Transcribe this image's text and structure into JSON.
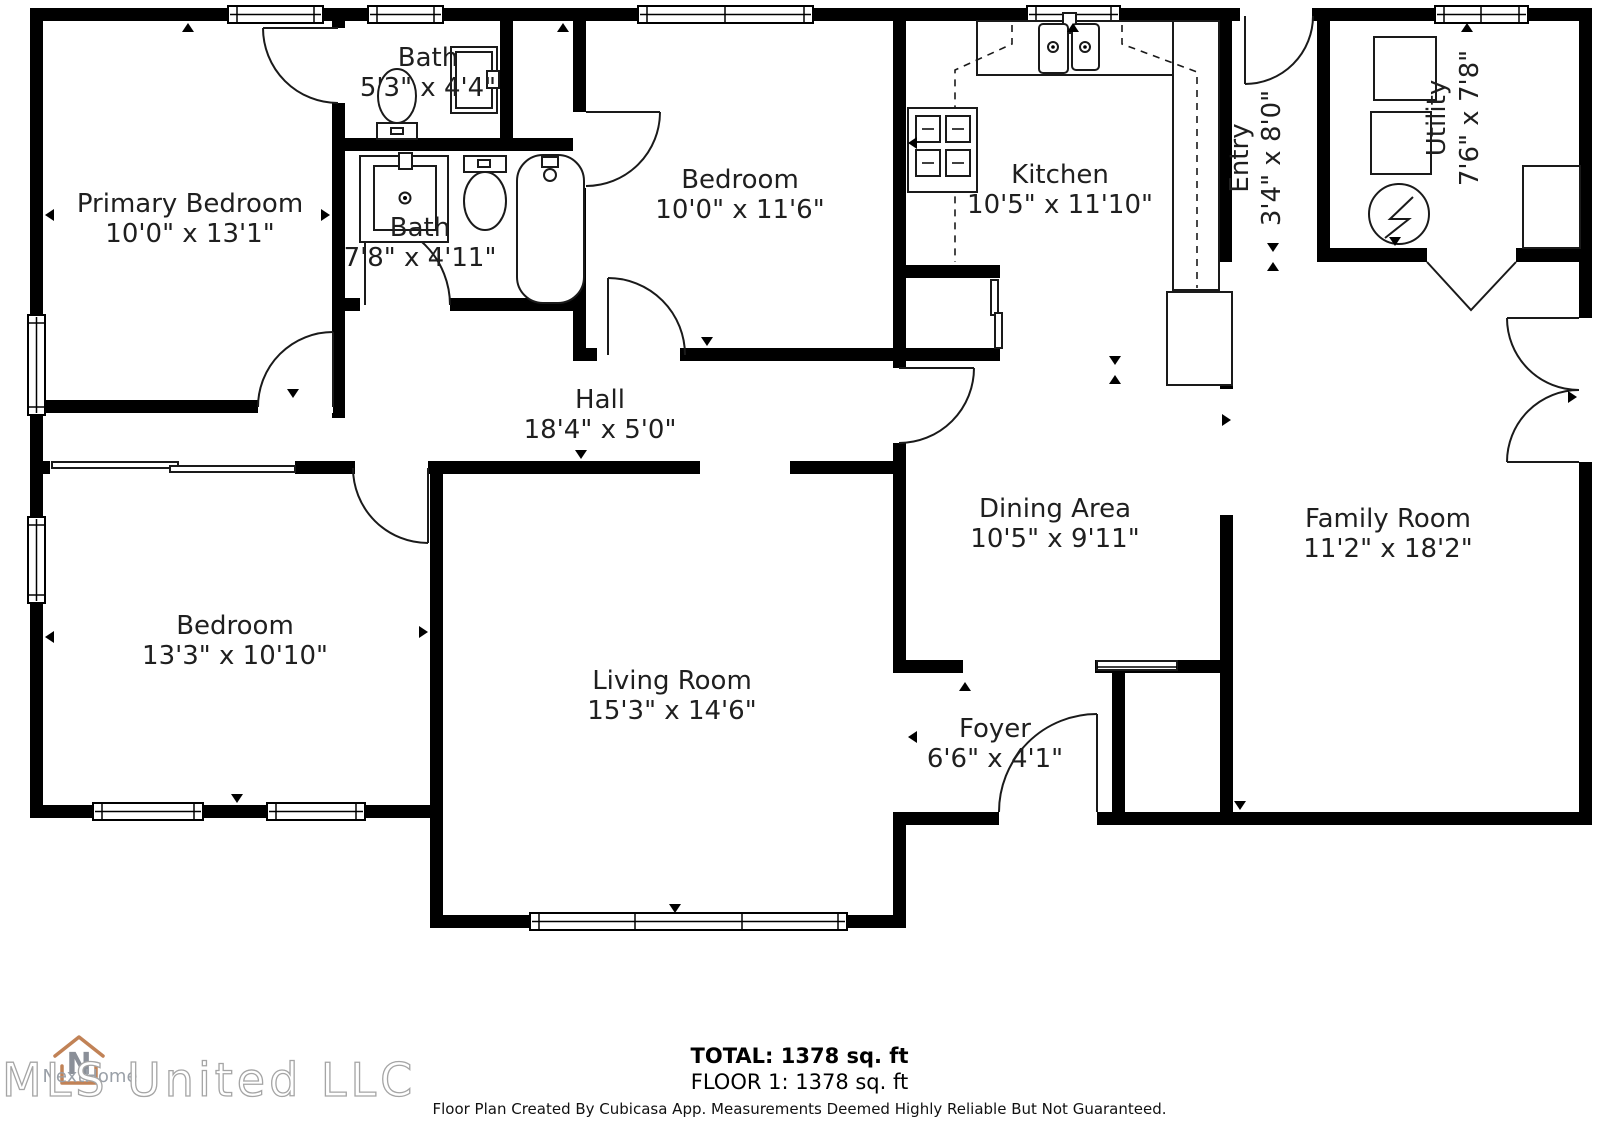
{
  "rooms": {
    "primary": {
      "name": "Primary Bedroom",
      "dims": "10'0\" x 13'1\""
    },
    "bath_ensuite": {
      "name": "Bath",
      "dims": "5'3\" x 4'4\""
    },
    "bath_hall": {
      "name": "Bath",
      "dims": "7'8\" x 4'11\""
    },
    "bedroom_front": {
      "name": "Bedroom",
      "dims": "10'0\" x 11'6\""
    },
    "kitchen": {
      "name": "Kitchen",
      "dims": "10'5\" x 11'10\""
    },
    "entry": {
      "name": "Entry",
      "dims": "3'4\" x 8'0\""
    },
    "utility": {
      "name": "Utility",
      "dims": "7'6\" x 7'8\""
    },
    "hall": {
      "name": "Hall",
      "dims": "18'4\" x 5'0\""
    },
    "dining": {
      "name": "Dining Area",
      "dims": "10'5\" x 9'11\""
    },
    "family": {
      "name": "Family Room",
      "dims": "11'2\" x 18'2\""
    },
    "bedroom_left": {
      "name": "Bedroom",
      "dims": "13'3\" x 10'10\""
    },
    "living": {
      "name": "Living Room",
      "dims": "15'3\" x 14'6\""
    },
    "foyer": {
      "name": "Foyer",
      "dims": "6'6\" x 4'1\""
    }
  },
  "summary": {
    "total": "TOTAL: 1378 sq. ft",
    "floor": "FLOOR 1: 1378 sq. ft"
  },
  "footer": {
    "disclaimer": "Floor Plan Created By Cubicasa App. Measurements Deemed Highly Reliable But Not Guaranteed."
  },
  "watermark": {
    "mls": "MLS United LLC",
    "brand": "NextHome",
    "north_letter": "N"
  },
  "colors": {
    "wall": "#000000",
    "background": "#ffffff",
    "label": "#1f1f1f",
    "brand_accent": "#c18256",
    "watermark_gray": "#a5a5a5"
  }
}
